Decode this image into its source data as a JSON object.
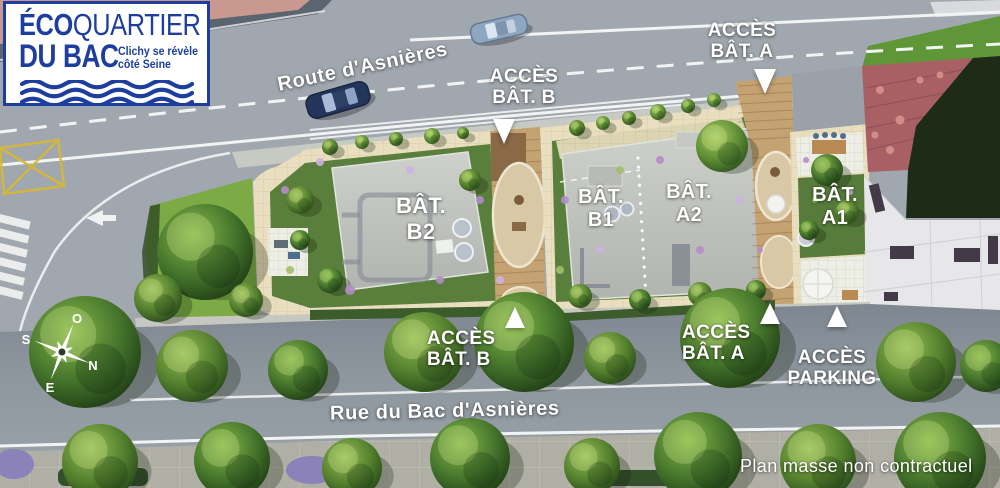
{
  "logo": {
    "title_bold": "ÉCO",
    "title_light": "QUARTIER",
    "subtitle": "DU BAC",
    "tagline1": "Clichy se révèle",
    "tagline2": "côté Seine"
  },
  "roads": {
    "top": "Route d'Asnières",
    "bottom": "Rue du Bac d'Asnières"
  },
  "access": {
    "top_b": {
      "l1": "ACCÈS",
      "l2": "BÂT. B"
    },
    "top_a": {
      "l1": "ACCÈS",
      "l2": "BÂT. A"
    },
    "bottom_b": {
      "l1": "ACCÈS",
      "l2": "BÂT. B"
    },
    "bottom_a": {
      "l1": "ACCÈS",
      "l2": "BÂT. A"
    },
    "parking": {
      "l1": "ACCÈS",
      "l2": "PARKING"
    }
  },
  "buildings": {
    "b2": {
      "l1": "BÂT.",
      "l2": "B2"
    },
    "b1": {
      "l1": "BÂT.",
      "l2": "B1"
    },
    "a2": {
      "l1": "BÂT.",
      "l2": "A2"
    },
    "a1": {
      "l1": "BÂT.",
      "l2": "A1"
    }
  },
  "compass": {
    "o": "O",
    "s": "S",
    "n": "N",
    "e": "E"
  },
  "disclaimer": "Plan masse non contractuel",
  "colors": {
    "brand_blue": "#1d3e9e",
    "marker_white": "#ffffff",
    "road_gray": "#99a0a7",
    "garden_green": "#5a7f3c",
    "terrace_beige": "#e9dfc0",
    "deck_wood": "#c4a272",
    "roof_gray": "#bfc2bd"
  }
}
